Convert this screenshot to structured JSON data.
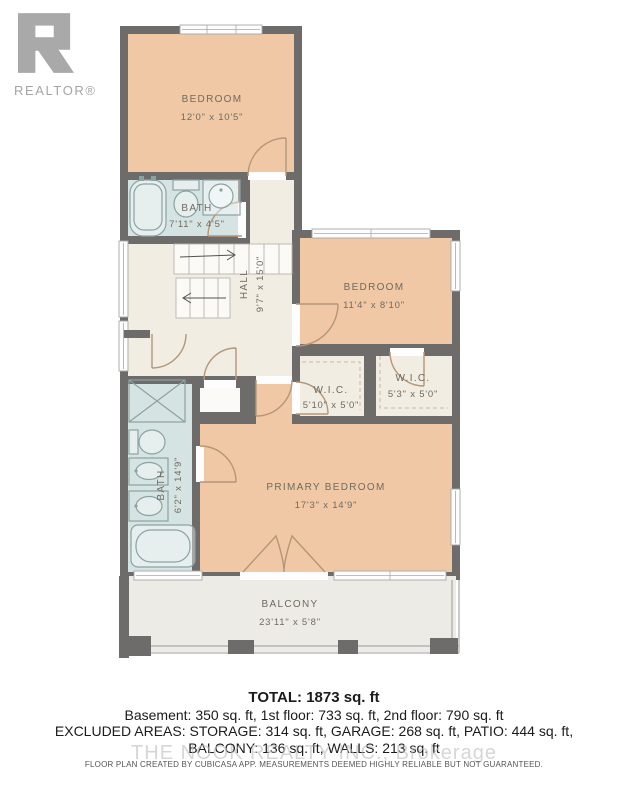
{
  "logo": {
    "text": "REALTOR®"
  },
  "rooms": {
    "bedroom_top": {
      "name": "BEDROOM",
      "dims": "12'0\" x 10'5\""
    },
    "bath_top": {
      "name": "BATH",
      "dims": "7'11\" x 4'5\""
    },
    "hall": {
      "name": "HALL",
      "dims": "9'7\" x 15'0\""
    },
    "bedroom_right": {
      "name": "BEDROOM",
      "dims": "11'4\" x 8'10\""
    },
    "wic_left": {
      "name": "W.I.C.",
      "dims": "5'10\" x 5'0\""
    },
    "wic_right": {
      "name": "W.I.C.",
      "dims": "5'3\" x 5'0\""
    },
    "primary_bedroom": {
      "name": "PRIMARY BEDROOM",
      "dims": "17'3\" x 14'9\""
    },
    "bath_left": {
      "name": "BATH",
      "dims": "6'2\" x 14'9\""
    },
    "balcony": {
      "name": "BALCONY",
      "dims": "23'11\" x 5'8\""
    }
  },
  "summary": {
    "total": "TOTAL: 1873 sq. ft",
    "floors": "Basement: 350 sq. ft, 1st floor: 733 sq. ft, 2nd floor: 790 sq. ft",
    "excluded_1": "EXCLUDED AREAS: STORAGE: 314 sq. ft, GARAGE: 268 sq. ft, PATIO: 444 sq. ft,",
    "excluded_2": "BALCONY: 136 sq. ft, WALLS: 213 sq. ft"
  },
  "watermark": {
    "text": "THE NOOK REALTY INC., Brokerage"
  },
  "disclaimer": {
    "text": "FLOOR PLAN CREATED BY CUBICASA APP. MEASUREMENTS DEEMED HIGHLY RELIABLE BUT NOT GUARANTEED."
  },
  "colors": {
    "wall": "#6e6c6a",
    "bedroom": "#f0c8a5",
    "bath": "#d5e4e3",
    "hall": "#f2ede3",
    "balcony": "#edebe5",
    "door_arc": "#b49678",
    "fixture": "#8ba2a2",
    "label": "#6f6a61",
    "logo_gray": "#a9a9a9"
  }
}
